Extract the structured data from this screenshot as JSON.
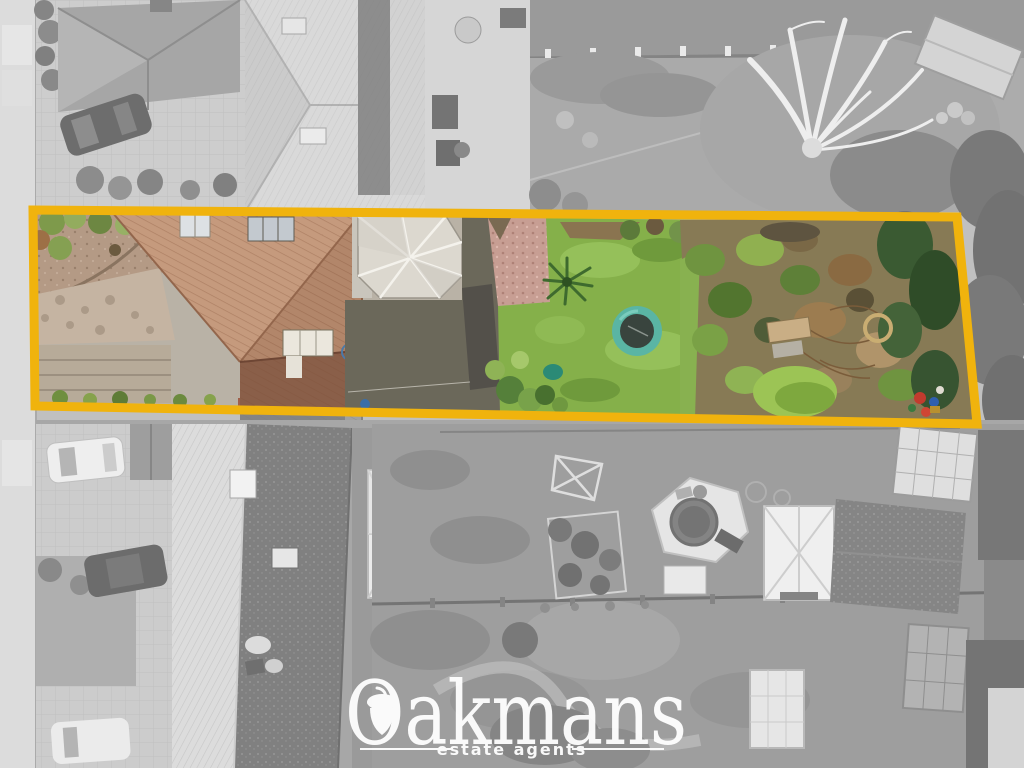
{
  "logo": {
    "name": "Oakmans",
    "tagline": "estate agents",
    "color": "#ffffff"
  },
  "boundary": {
    "points": "33,210 957,217 977,424 35,406",
    "color": "#F0B30D",
    "stroke_width": "9"
  },
  "scene": {
    "type": "aerial-drone-photo",
    "effect": "surroundings desaturated, highlighted plot shown in colour",
    "highlight_palette": {
      "roof_terracotta": "#c59a7d",
      "lawn_green": "#85b04a",
      "trampoline_teal": "#5ab5a4",
      "gravel_pink": "#c79e93",
      "conservatory_white": "#dcd8cf"
    }
  }
}
